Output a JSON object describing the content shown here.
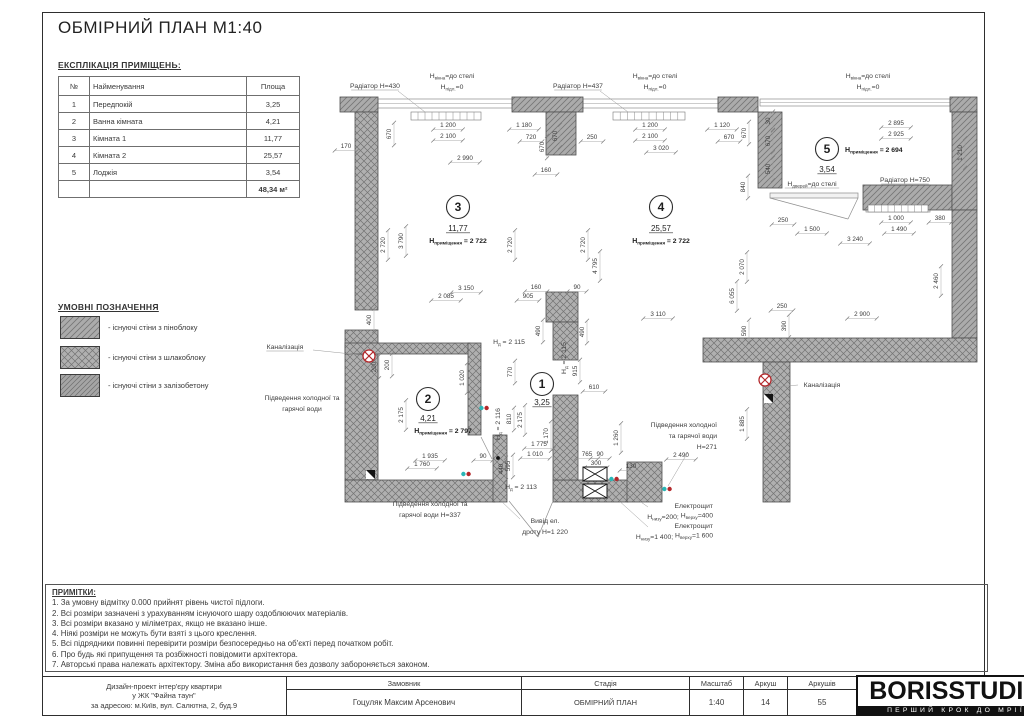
{
  "header": {
    "title": "ОБМІРНИЙ ПЛАН М1:40"
  },
  "schedule": {
    "heading": "ЕКСПЛІКАЦІЯ ПРИМІЩЕНЬ:",
    "columns": [
      "№",
      "Найменування",
      "Площа"
    ],
    "rows": [
      [
        "1",
        "Передпокій",
        "3,25"
      ],
      [
        "2",
        "Ванна кімната",
        "4,21"
      ],
      [
        "3",
        "Кімната 1",
        "11,77"
      ],
      [
        "4",
        "Кімната 2",
        "25,57"
      ],
      [
        "5",
        "Лоджія",
        "3,54"
      ]
    ],
    "total": "48,34 м²"
  },
  "legend": {
    "heading": "УМОВНІ ПОЗНАЧЕННЯ",
    "items": [
      {
        "label": "- існуючі стіни з піноблоку",
        "pattern": "diag",
        "y": 316
      },
      {
        "label": "- існуючі стіни з шлакоблоку",
        "pattern": "cross",
        "y": 346
      },
      {
        "label": "- існуючі стіни з залізобетону",
        "pattern": "diag2",
        "y": 374
      }
    ]
  },
  "notes": {
    "heading": "ПРИМІТКИ:",
    "items": [
      "1. За умовну відмітку 0.000 прийнят рівень чистої підлоги.",
      "2. Всі розміри зазначені з урахуванням існуючого шару оздоблюючих матеріалів.",
      "3. Всі розміри вказано у міліметрах, якщо не вказано інше.",
      "4. Ніякі розміри не можуть бути взяті з цього креслення.",
      "5. Всі підрядники повинні перевірити розміри безпосередньо на об'єкті перед початком робіт.",
      "6. Про будь які припущення та розбіжності повідомити архітектора.",
      "7. Авторські права належать архітектору. Зміна або використання без дозволу забороняється законом."
    ]
  },
  "titleblock": {
    "project_lines": [
      "Дизайн-проект інтер'єру квартири",
      "у ЖК \"Файна таун\"",
      "за адресою: м.Київ, вул. Салютна, 2, буд.9"
    ],
    "customer_label": "Замовник",
    "customer": "Гоцуляк Максим Арсенович",
    "stage_label": "Стадія",
    "stage": "ОБМІРНИЙ ПЛАН",
    "scale_label": "Масштаб",
    "scale": "1:40",
    "sheet_label": "Аркуш",
    "sheet": "14",
    "sheets_label": "Аркушів",
    "sheets": "55",
    "logo": "BORISSTUDIO",
    "slogan": "ПЕРШИЙ КРОК ДО МРІЇ"
  },
  "colors": {
    "wall_fill": "#ababab",
    "hatch": "#767676",
    "dim": "#3d3d3d",
    "red": "#b3272a",
    "cyan": "#29b6b6"
  },
  "plan": {
    "walls": [
      [
        340,
        97,
        38,
        15,
        "diag"
      ],
      [
        355,
        112,
        23,
        198,
        "cross"
      ],
      [
        345,
        330,
        33,
        150,
        "cross"
      ],
      [
        345,
        343,
        125,
        11,
        "cross"
      ],
      [
        468,
        343,
        13,
        92,
        "cross"
      ],
      [
        345,
        480,
        150,
        22,
        "cross"
      ],
      [
        553,
        480,
        75,
        22,
        "cross"
      ],
      [
        512,
        97,
        71,
        15,
        "diag"
      ],
      [
        546,
        112,
        30,
        43,
        "diag"
      ],
      [
        546,
        292,
        32,
        30,
        "cross"
      ],
      [
        553,
        322,
        25,
        38,
        "cross"
      ],
      [
        553,
        395,
        25,
        85,
        "cross"
      ],
      [
        718,
        97,
        40,
        15,
        "diag"
      ],
      [
        758,
        112,
        24,
        76,
        "diag"
      ],
      [
        863,
        185,
        89,
        25,
        "diag"
      ],
      [
        950,
        97,
        27,
        15,
        "diag"
      ],
      [
        952,
        112,
        25,
        98,
        "diag"
      ],
      [
        952,
        210,
        25,
        128,
        "diag"
      ],
      [
        703,
        338,
        274,
        24,
        "cross"
      ],
      [
        763,
        362,
        27,
        140,
        "cross"
      ],
      [
        627,
        462,
        35,
        40,
        "cross"
      ],
      [
        493,
        435,
        14,
        67,
        "cross"
      ]
    ],
    "windows": [
      [
        378,
        99,
        134,
        9
      ],
      [
        583,
        99,
        135,
        9
      ],
      [
        760,
        99,
        190,
        7
      ],
      [
        866,
        204,
        64,
        8
      ]
    ],
    "combs": [
      [
        411,
        112,
        70,
        8,
        10
      ],
      [
        613,
        112,
        72,
        8,
        10
      ],
      [
        868,
        205,
        60,
        7,
        9
      ]
    ],
    "leafs": [
      [
        770,
        193,
        88,
        5
      ]
    ],
    "doors": [
      "M770,198 L848,219 M858,198 L848,219",
      "M509,501 L538,537 M553,501 L538,537",
      "M481,437 L492,459"
    ],
    "dims": [
      [
        "670",
        391,
        134,
        1
      ],
      [
        "170",
        346,
        148,
        0
      ],
      [
        "1 200",
        448,
        127,
        0
      ],
      [
        "1 180",
        524,
        127,
        0
      ],
      [
        "2 100",
        448,
        138,
        0
      ],
      [
        "720",
        531,
        139,
        0
      ],
      [
        "670",
        544,
        147,
        1
      ],
      [
        "2 990",
        465,
        160,
        0
      ],
      [
        "160",
        546,
        172,
        0
      ],
      [
        "670",
        557,
        136,
        1
      ],
      [
        "250",
        592,
        139,
        0
      ],
      [
        "1 200",
        650,
        127,
        0
      ],
      [
        "1 120",
        722,
        127,
        0
      ],
      [
        "2 100",
        650,
        138,
        0
      ],
      [
        "670",
        729,
        139,
        0
      ],
      [
        "3 020",
        661,
        150,
        0
      ],
      [
        "670",
        746,
        133,
        1
      ],
      [
        "840",
        745,
        187,
        1
      ],
      [
        "30",
        770,
        121,
        1
      ],
      [
        "670",
        770,
        141,
        1
      ],
      [
        "540",
        770,
        169,
        1
      ],
      [
        "2 895",
        896,
        125,
        0
      ],
      [
        "2 925",
        896,
        136,
        0
      ],
      [
        "1 210",
        962,
        153,
        1
      ],
      [
        "250",
        783,
        222,
        0
      ],
      [
        "1 500",
        812,
        231,
        0
      ],
      [
        "1 000",
        896,
        220,
        0
      ],
      [
        "380",
        940,
        220,
        0
      ],
      [
        "1 490",
        899,
        231,
        0
      ],
      [
        "3 240",
        855,
        241,
        0
      ],
      [
        "2 460",
        938,
        281,
        1
      ],
      [
        "2 070",
        744,
        267,
        1
      ],
      [
        "6 055",
        734,
        296,
        1
      ],
      [
        "2 720",
        385,
        245,
        1
      ],
      [
        "3 790",
        403,
        241,
        1
      ],
      [
        "2 720",
        512,
        245,
        1
      ],
      [
        "2 720",
        585,
        245,
        1
      ],
      [
        "4 795",
        597,
        266,
        1
      ],
      [
        "3 150",
        466,
        290,
        0
      ],
      [
        "2 085",
        446,
        298,
        0
      ],
      [
        "905",
        528,
        298,
        0
      ],
      [
        "160",
        536,
        289,
        0
      ],
      [
        "90",
        577,
        289,
        0
      ],
      [
        "3 110",
        658,
        316,
        0
      ],
      [
        "250",
        782,
        308,
        0
      ],
      [
        "2 900",
        862,
        316,
        0
      ],
      [
        "400",
        371,
        320,
        1
      ],
      [
        "490",
        540,
        331,
        1
      ],
      [
        "490",
        584,
        332,
        1
      ],
      [
        "590",
        746,
        331,
        1
      ],
      [
        "390",
        786,
        326,
        1
      ],
      [
        "1 885",
        744,
        424,
        1
      ],
      [
        "200",
        376,
        367,
        1
      ],
      [
        "200",
        389,
        365,
        1
      ],
      [
        "1 020",
        464,
        378,
        1
      ],
      [
        "770",
        512,
        372,
        1
      ],
      [
        "915",
        577,
        371,
        1
      ],
      [
        "610",
        594,
        389,
        0
      ],
      [
        "2 175",
        403,
        415,
        1
      ],
      [
        "2 175",
        522,
        420,
        1
      ],
      [
        "810",
        511,
        419,
        1
      ],
      [
        "1 170",
        548,
        436,
        1
      ],
      [
        "1 260",
        618,
        438,
        1
      ],
      [
        "1 775",
        539,
        446,
        0
      ],
      [
        "1 935",
        430,
        458,
        0
      ],
      [
        "90",
        483,
        458,
        0
      ],
      [
        "1 760",
        422,
        466,
        0
      ],
      [
        "1 010",
        535,
        456,
        0
      ],
      [
        "765",
        587,
        456,
        0
      ],
      [
        "90",
        600,
        456,
        0
      ],
      [
        "300",
        596,
        465,
        0
      ],
      [
        "440",
        503,
        469,
        1
      ],
      [
        "595",
        510,
        466,
        1
      ],
      [
        "130",
        631,
        468,
        0
      ],
      [
        "2 490",
        681,
        457,
        0
      ]
    ],
    "labels": [
      {
        "x": 375,
        "y": 88,
        "u": 1,
        "p": [
          [
            "Радіатор Н=430"
          ]
        ]
      },
      {
        "x": 578,
        "y": 88,
        "u": 1,
        "p": [
          [
            "Радіатор Н=437"
          ]
        ]
      },
      {
        "x": 452,
        "y": 78,
        "p": [
          [
            "Н"
          ],
          [
            "вікна",
            1
          ],
          [
            "=до стелі"
          ]
        ]
      },
      {
        "x": 452,
        "y": 89,
        "p": [
          [
            "Н"
          ],
          [
            "підл.",
            1
          ],
          [
            "=0"
          ]
        ]
      },
      {
        "x": 655,
        "y": 78,
        "p": [
          [
            "Н"
          ],
          [
            "вікна",
            1
          ],
          [
            "=до стелі"
          ]
        ]
      },
      {
        "x": 655,
        "y": 89,
        "p": [
          [
            "Н"
          ],
          [
            "підл.",
            1
          ],
          [
            "=0"
          ]
        ]
      },
      {
        "x": 868,
        "y": 78,
        "p": [
          [
            "Н"
          ],
          [
            "вікна",
            1
          ],
          [
            "=до стелі"
          ]
        ]
      },
      {
        "x": 868,
        "y": 89,
        "p": [
          [
            "Н"
          ],
          [
            "підл.",
            1
          ],
          [
            "=0"
          ]
        ]
      },
      {
        "x": 812,
        "y": 186,
        "u": 1,
        "p": [
          [
            "Н"
          ],
          [
            "дверей",
            1
          ],
          [
            "=до стелі"
          ]
        ]
      },
      {
        "x": 905,
        "y": 182,
        "u": 1,
        "p": [
          [
            "Радіатор Н=750"
          ]
        ]
      },
      {
        "x": 285,
        "y": 349,
        "u": 1,
        "p": [
          [
            "Каналізація"
          ]
        ]
      },
      {
        "x": 822,
        "y": 387,
        "p": [
          [
            "Каналізація"
          ]
        ]
      },
      {
        "x": 302,
        "y": 400,
        "p": [
          [
            "Підведення холодної та"
          ]
        ]
      },
      {
        "x": 302,
        "y": 411,
        "p": [
          [
            "гарячої води"
          ]
        ]
      },
      {
        "x": 430,
        "y": 506,
        "p": [
          [
            "Підведення холодної та"
          ]
        ]
      },
      {
        "x": 430,
        "y": 517,
        "p": [
          [
            "гарячої води Н=337"
          ]
        ]
      },
      {
        "x": 545,
        "y": 523,
        "p": [
          [
            "Вивід ел."
          ]
        ]
      },
      {
        "x": 545,
        "y": 534,
        "p": [
          [
            "дроту Н=1 220"
          ]
        ]
      },
      {
        "x": 717,
        "y": 427,
        "a": "e",
        "p": [
          [
            "Підведення холодної"
          ]
        ]
      },
      {
        "x": 717,
        "y": 438,
        "a": "e",
        "p": [
          [
            "та гарячої води"
          ]
        ]
      },
      {
        "x": 717,
        "y": 449,
        "a": "e",
        "p": [
          [
            "Н=271"
          ]
        ]
      },
      {
        "x": 713,
        "y": 508,
        "a": "e",
        "p": [
          [
            "Електрощит"
          ]
        ]
      },
      {
        "x": 713,
        "y": 519,
        "a": "e",
        "p": [
          [
            "Н"
          ],
          [
            "низу",
            1
          ],
          [
            "=200; "
          ],
          [
            "Н"
          ],
          [
            "верху",
            1
          ],
          [
            "=400"
          ]
        ]
      },
      {
        "x": 713,
        "y": 528,
        "a": "e",
        "p": [
          [
            "Електрощит"
          ]
        ]
      },
      {
        "x": 713,
        "y": 539,
        "a": "e",
        "p": [
          [
            "Н"
          ],
          [
            "низу",
            1
          ],
          [
            "=1 400; "
          ],
          [
            "Н"
          ],
          [
            "верху",
            1
          ],
          [
            "=1 600"
          ]
        ]
      },
      {
        "x": 509,
        "y": 344,
        "p": [
          [
            "Н"
          ],
          [
            "д",
            1
          ],
          [
            " = 2 115"
          ]
        ]
      },
      {
        "x": 566,
        "y": 358,
        "o": 1,
        "p": [
          [
            "Н"
          ],
          [
            "д",
            1
          ],
          [
            " = 2 115"
          ]
        ]
      },
      {
        "x": 500,
        "y": 424,
        "o": 1,
        "p": [
          [
            "Н"
          ],
          [
            "д",
            1
          ],
          [
            " = 2 116"
          ]
        ]
      },
      {
        "x": 521,
        "y": 489,
        "p": [
          [
            "Н"
          ],
          [
            "д",
            1
          ],
          [
            " = 2 113"
          ]
        ]
      }
    ],
    "rooms": [
      {
        "n": "3",
        "x": 458,
        "y": 207,
        "area": "11,77",
        "ax": 458,
        "ay": 231,
        "h": "2 722",
        "hx": 458,
        "hy": 243
      },
      {
        "n": "4",
        "x": 661,
        "y": 207,
        "area": "25,57",
        "ax": 661,
        "ay": 231,
        "h": "2 722",
        "hx": 661,
        "hy": 243
      },
      {
        "n": "5",
        "x": 827,
        "y": 149,
        "area": "3,54",
        "ax": 827,
        "ay": 172,
        "h": "2 694",
        "hx": 845,
        "hy": 152,
        "ha": "s"
      },
      {
        "n": "2",
        "x": 428,
        "y": 399,
        "area": "4,21",
        "ax": 428,
        "ay": 421,
        "h": "2 797",
        "hx": 443,
        "hy": 433
      },
      {
        "n": "1",
        "x": 542,
        "y": 384,
        "area": "3,25",
        "ax": 542,
        "ay": 405
      }
    ],
    "symbols": [
      {
        "t": "canal",
        "x": 369,
        "y": 356
      },
      {
        "t": "canal",
        "x": 765,
        "y": 380
      },
      {
        "t": "elecbox",
        "x": 583,
        "y": 467
      },
      {
        "t": "elecbox",
        "x": 583,
        "y": 484
      },
      {
        "t": "mark",
        "x": 366,
        "y": 470
      },
      {
        "t": "mark",
        "x": 764,
        "y": 394
      },
      {
        "t": "water",
        "x": 484,
        "y": 408
      },
      {
        "t": "water",
        "x": 466,
        "y": 474
      },
      {
        "t": "water",
        "x": 614,
        "y": 479
      },
      {
        "t": "water",
        "x": 667,
        "y": 489
      },
      {
        "t": "dot",
        "x": 498,
        "y": 458
      }
    ],
    "leaders": [
      [
        398,
        91,
        425,
        112
      ],
      [
        600,
        91,
        628,
        112
      ],
      [
        905,
        186,
        896,
        204
      ],
      [
        313,
        350,
        361,
        355
      ],
      [
        775,
        387,
        798,
        385
      ],
      [
        520,
        519,
        500,
        500
      ],
      [
        648,
        507,
        607,
        478
      ],
      [
        648,
        527,
        606,
        489
      ],
      [
        688,
        452,
        668,
        486
      ]
    ]
  }
}
